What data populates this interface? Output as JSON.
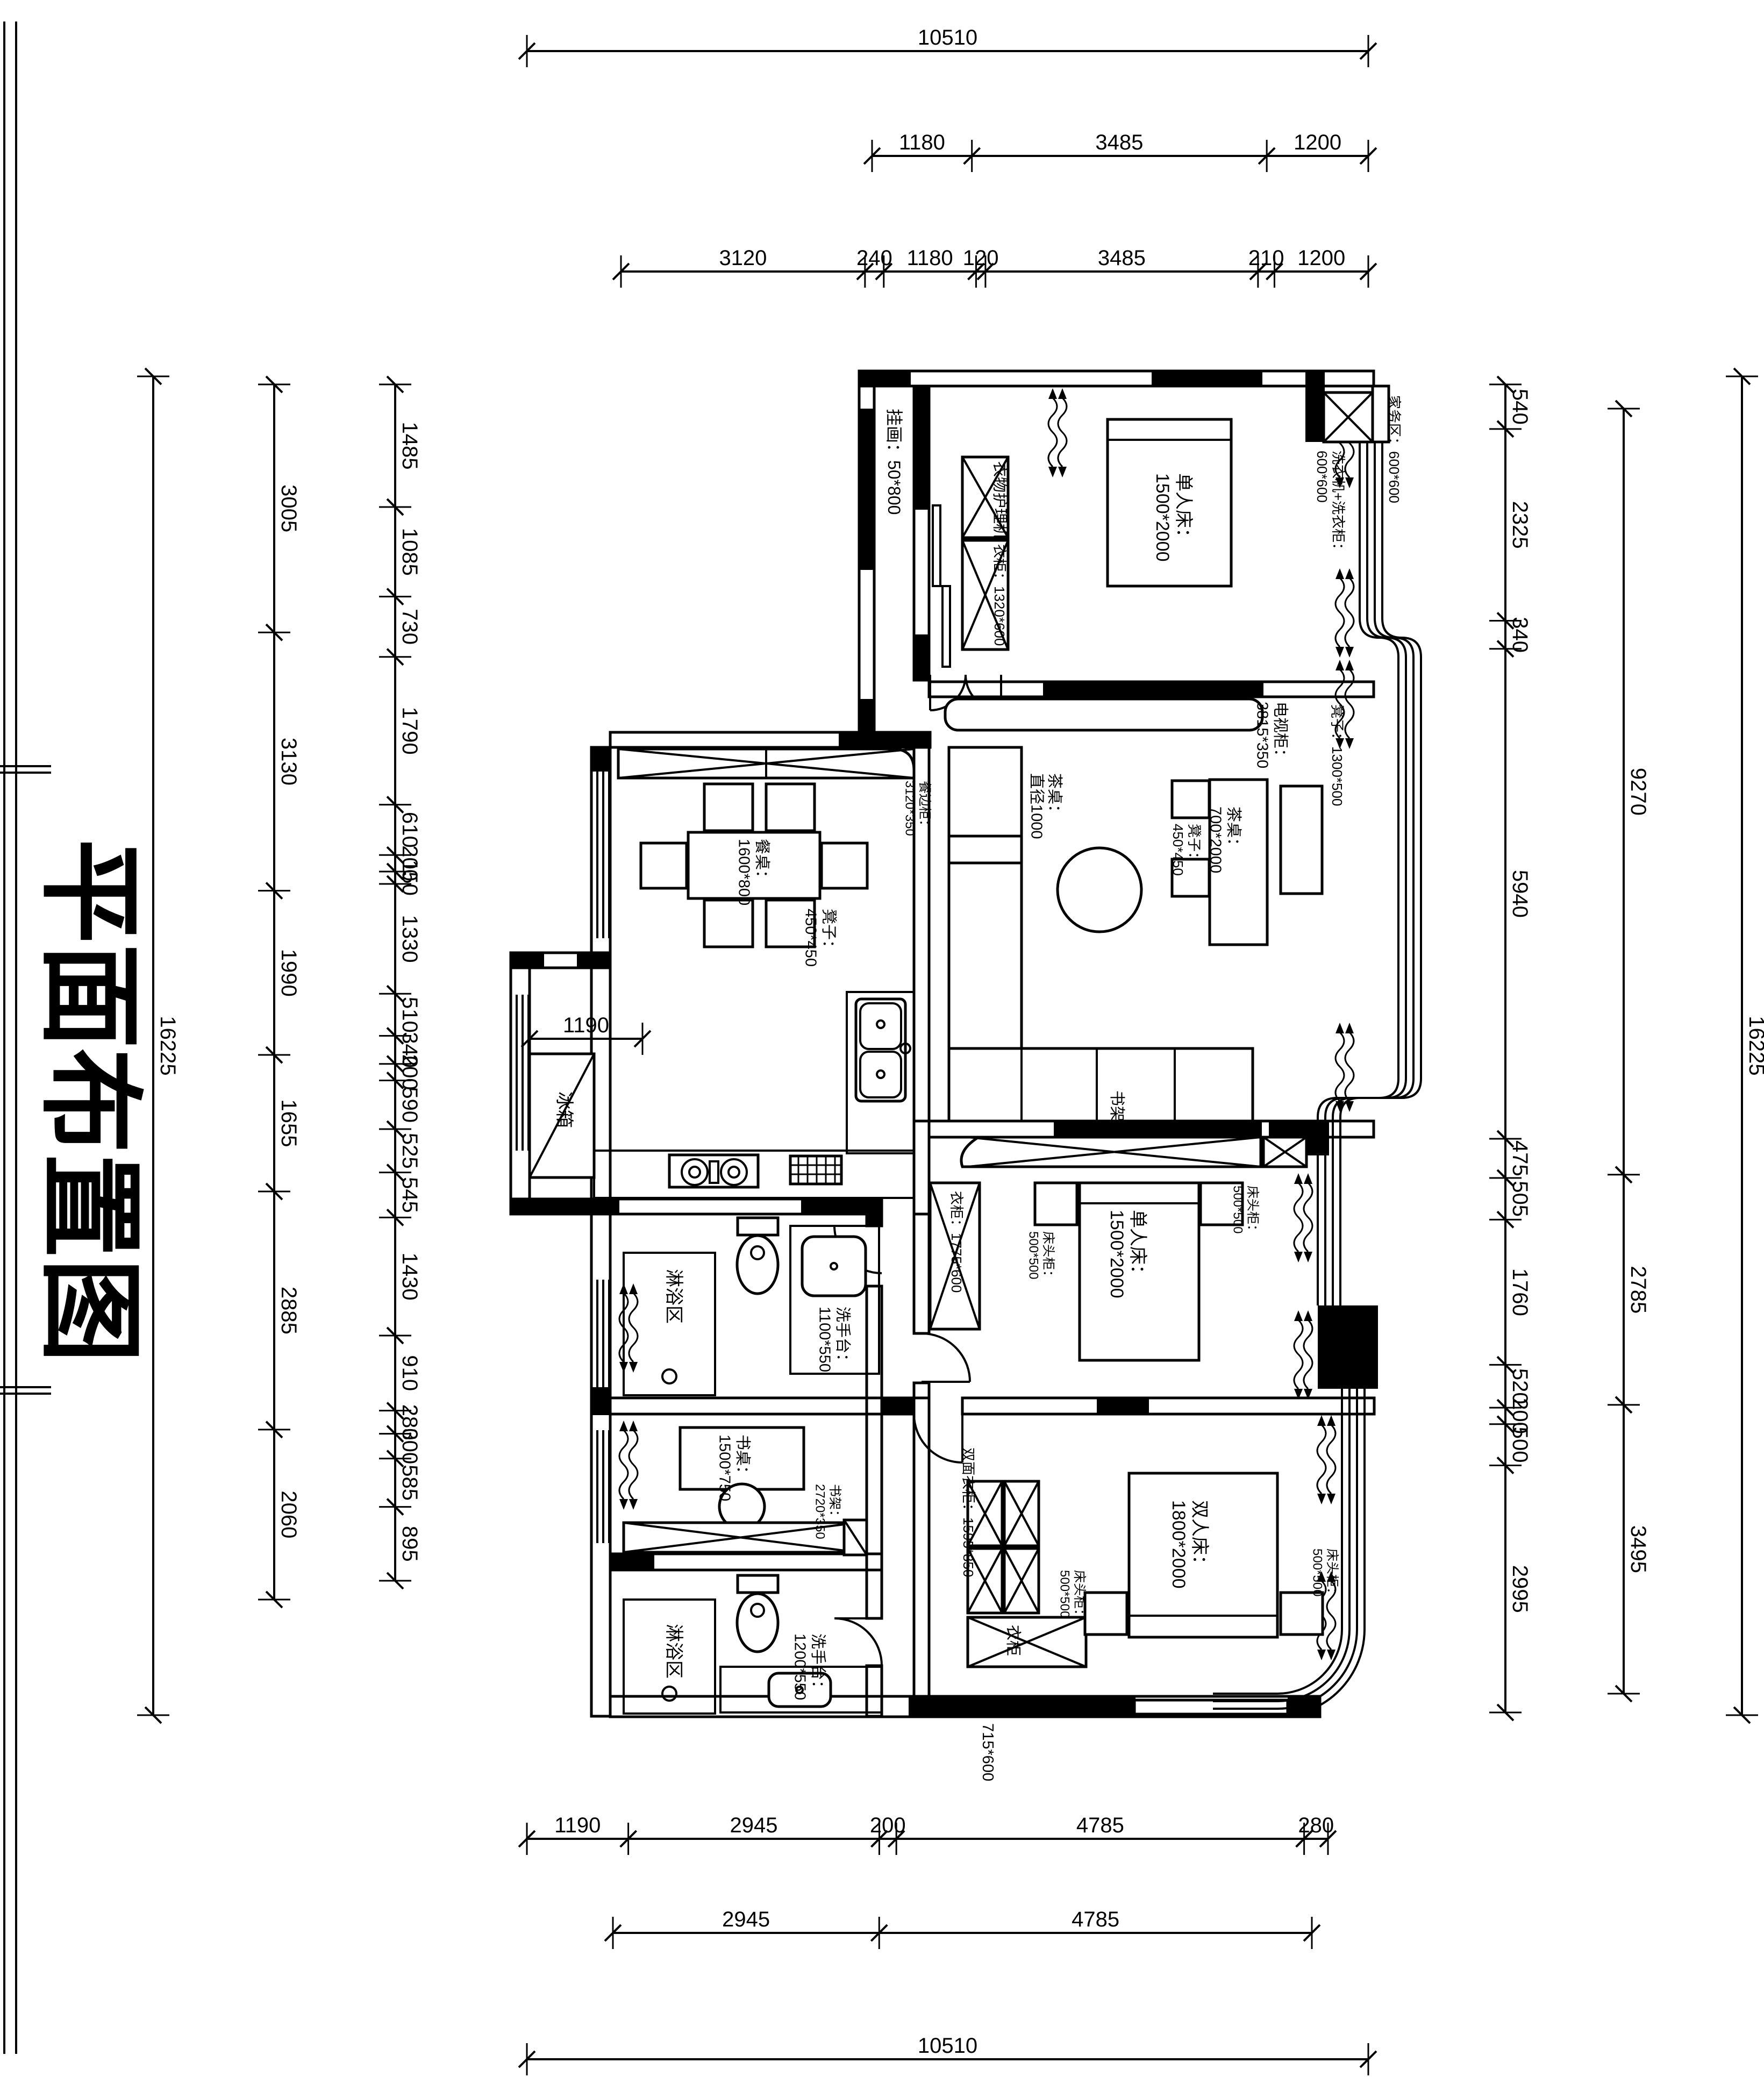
{
  "title": "平面布置图",
  "labels": {
    "guahua": "挂画：50*800",
    "yiwu_care": "衣物护理机",
    "yigui_b1": "衣柜：1320*600",
    "bed_single_1": "单人床：1500*2000",
    "tv_cabinet": "电视柜：3815*350",
    "jiawu": "家务区：600*600",
    "washer": "洗衣机+洗衣柜：600*600",
    "canbiangui": "餐边柜：3120*350",
    "canzhuo": "餐桌：1600*800",
    "dengzi_can": "凳子：450*450",
    "dengzi_bench": "凳子：1300*500",
    "chazhuo": "茶桌：700*2000",
    "dengzi_cha": "凳子：450*450",
    "chaji": "茶桌：直径1000",
    "shujia_l": "书架",
    "bingxiang": "冰箱",
    "linyu_1": "淋浴区",
    "xishoutai_1": "洗手台：1100*550",
    "yigui_b2": "衣柜：1775*600",
    "ctg_b2l": "床头柜：500*500",
    "bed_single_2": "单人床：1500*2000",
    "ctg_b2r": "床头柜：500*500",
    "shuzhuo": "书桌：1500*750",
    "shujia_s": "书架：2720*350",
    "linyu_2": "淋浴区",
    "xishoutai_2": "洗手台：1200*550",
    "shuangmian": "双面衣柜：1595*850",
    "ctg_ml": "床头柜：500*500",
    "bed_double": "双人床：1800*2000",
    "ctg_mr": "床头柜：500*500",
    "yigui_m": "衣柜",
    "yigui_m_size": "715*600"
  },
  "dims": {
    "chains": [
      {
        "name": "top-overall",
        "orient": "h",
        "pos": 95,
        "from": 980,
        "to": 2545,
        "values": [
          "10510"
        ]
      },
      {
        "name": "top-mid",
        "orient": "h",
        "pos": 290,
        "from": 1622,
        "to": 2545,
        "values": [
          "1180",
          "3485",
          "1200"
        ]
      },
      {
        "name": "top-detail",
        "orient": "h",
        "pos": 505,
        "from": 1155,
        "to": 2545,
        "values": [
          "3120",
          "240",
          "1180",
          "120",
          "3485",
          "210",
          "1200"
        ]
      },
      {
        "name": "kitchen-inner",
        "orient": "h",
        "pos": 1932,
        "from": 985,
        "to": 1195,
        "values": [
          "1190"
        ]
      },
      {
        "name": "bottom-detail",
        "orient": "h",
        "pos": 3420,
        "from": 980,
        "to": 2470,
        "values": [
          "1190",
          "2945",
          "200",
          "4785",
          "280"
        ]
      },
      {
        "name": "bottom-mid",
        "orient": "h",
        "pos": 3595,
        "from": 1140,
        "to": 2440,
        "values": [
          "2945",
          "4785"
        ]
      },
      {
        "name": "bottom-overall",
        "orient": "h",
        "pos": 3830,
        "from": 980,
        "to": 2545,
        "values": [
          "10510"
        ]
      },
      {
        "name": "left-overall",
        "orient": "v",
        "pos": 285,
        "from": 700,
        "to": 3190,
        "values": [
          "16225"
        ]
      },
      {
        "name": "left-rooms",
        "orient": "v",
        "pos": 510,
        "from": 715,
        "to": 2975,
        "values": [
          "3005",
          "3130",
          "1990",
          "1655",
          "2885",
          "2060"
        ]
      },
      {
        "name": "left-detail",
        "orient": "v",
        "pos": 735,
        "from": 715,
        "to": 2940,
        "values": [
          "1485",
          "1085",
          "730",
          "1790",
          "610",
          "200",
          "150",
          "1330",
          "510",
          "340",
          "200",
          "590",
          "525",
          "545",
          "1430",
          "910",
          "280",
          "300",
          "585",
          "895"
        ]
      },
      {
        "name": "right-detail",
        "orient": "v",
        "pos": 2800,
        "from": 715,
        "to": 3185,
        "values": [
          "540",
          "2325",
          "340",
          "5940",
          "475",
          "505",
          "1760",
          "520",
          "200",
          "500",
          "2995"
        ]
      },
      {
        "name": "right-mid",
        "orient": "v",
        "pos": 3020,
        "from": 760,
        "to": 3150,
        "values": [
          "9270",
          "2785",
          "3495"
        ]
      },
      {
        "name": "right-overall",
        "orient": "v",
        "pos": 3240,
        "from": 700,
        "to": 3190,
        "values": [
          "16225"
        ]
      }
    ]
  }
}
